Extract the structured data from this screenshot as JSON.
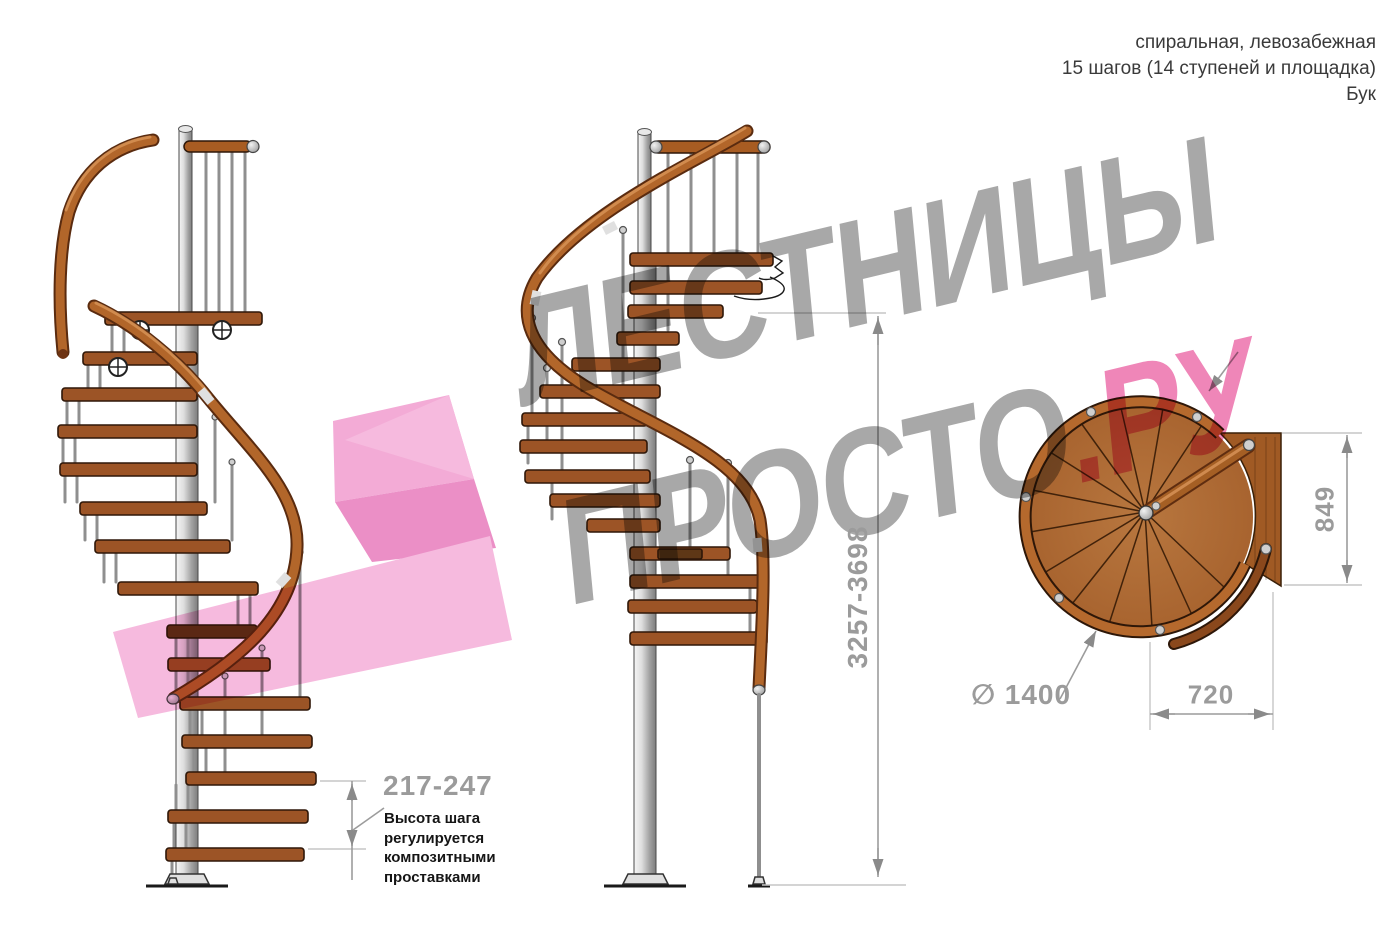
{
  "header": {
    "line1": "спиральная, левозабежная",
    "line2": "15 шагов (14 ступеней и площадка)",
    "line3": "Бук"
  },
  "watermark": {
    "line1": "ЛЕСТНИЦЫ",
    "line2_main": "ПРОСТО",
    "line2_accent": ".РУ"
  },
  "annotations": {
    "step_height_value": "217-247",
    "step_height_note": [
      "Высота шага",
      "регулируется",
      "композитными",
      "проставками"
    ],
    "total_height_value": "3257-3698",
    "landing_depth_value": "849",
    "step_width_value": "720",
    "diameter_value": "∅ 1400"
  },
  "colors": {
    "wood_step": "#9c5426",
    "handrail": "#b2662a",
    "metal_pole": "#c9c9c9",
    "dimension_gray": "#9b9b9b",
    "watermark_gray": "#a8a8a8",
    "watermark_pink": "#ef86b8",
    "logo_pink": "#f6bade"
  }
}
